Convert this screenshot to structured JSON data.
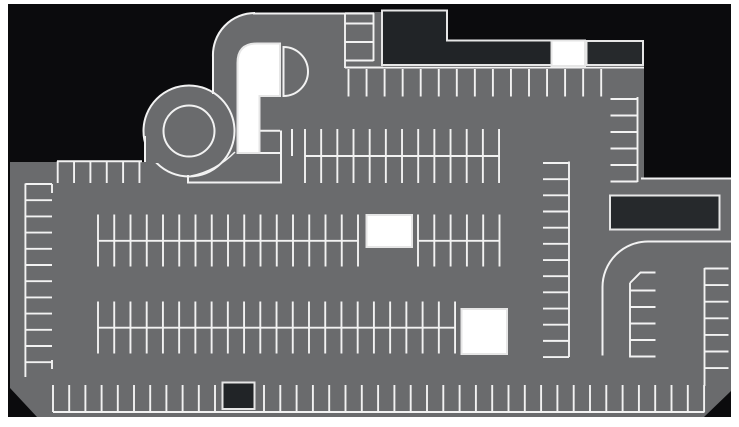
{
  "meta": {
    "title": "parking-lot-site-map",
    "width": 739,
    "height": 427
  },
  "colors": {
    "page": "#ffffff",
    "ground": "#0b0b0d",
    "lot": "#6a6b6d",
    "line": "#f2f2f2",
    "line_soft": "#e2e2e2",
    "building_dark": "#212427",
    "building_dark2": "#26292c",
    "building_white": "#ffffff",
    "outline": "#e6e6e6"
  },
  "map": {
    "ground": {
      "name": "ground-plane",
      "x": 8,
      "y": 4,
      "w": 723,
      "h": 413
    },
    "grays": [
      {
        "type": "rect",
        "name": "main-lot-surface",
        "x": 10,
        "y": 162,
        "w": 721,
        "h": 255
      },
      {
        "type": "rect",
        "name": "upper-lot-surface",
        "x": 345,
        "y": 67,
        "w": 299,
        "h": 123
      },
      {
        "type": "path",
        "name": "ramp-corner-surface",
        "d": "M213,93 L213,57 A42 42 0 0 1 255,13 L345,13 L345,190 L213,190 Z"
      },
      {
        "type": "rect",
        "name": "upper-stall-strip",
        "x": 345,
        "y": 12,
        "w": 38,
        "h": 56
      },
      {
        "type": "circle",
        "name": "spiral-ramp-disk",
        "cx": 189,
        "cy": 131,
        "r": 45.5,
        "stroke": true
      },
      {
        "type": "path",
        "name": "lot-edge-wedge",
        "d": "M145,163 L145,135 Q151,154 160,163 Z"
      }
    ],
    "patches": [
      {
        "type": "rect",
        "name": "ground-notch-topright",
        "x": 644,
        "y": 162,
        "w": 87,
        "h": 17
      },
      {
        "type": "path",
        "name": "cut-corner-bottomleft",
        "d": "M10,388 L37,417 L10,417 Z"
      },
      {
        "type": "path",
        "name": "cut-corner-bottomright",
        "d": "M731,391 L731,417 L704,417 Z"
      }
    ],
    "roads": [
      {
        "type": "circle",
        "name": "spiral-ramp-inner-circle",
        "cx": 189,
        "cy": 131,
        "r": 25.5
      },
      {
        "type": "path",
        "name": "ramp-corner-curb",
        "d": "M213,57 A42 42 0 0 1 255,13"
      },
      {
        "type": "line",
        "name": "ramp-west-curb",
        "x1": 213,
        "y1": 57,
        "x2": 213,
        "y2": 94
      },
      {
        "type": "line",
        "name": "north-curb-line",
        "x1": 253,
        "y1": 13.5,
        "x2": 374,
        "y2": 13.5
      },
      {
        "type": "line",
        "name": "west-curb-line",
        "x1": 145,
        "y1": 136,
        "x2": 145,
        "y2": 162
      },
      {
        "type": "line",
        "name": "northwest-curb-line",
        "x1": 57,
        "y1": 161.3,
        "x2": 142,
        "y2": 161.3
      },
      {
        "type": "path",
        "name": "ramp-stem-curb",
        "d": "M188,175 L188,182.5 L281,182.5 L281,130.5"
      },
      {
        "type": "path",
        "name": "ramp-stem-arc",
        "d": "M191,176 Q216,171 235,152",
        "w": 1.5
      },
      {
        "type": "line",
        "name": "ramp-base-line",
        "x1": 238,
        "y1": 153,
        "x2": 280,
        "y2": 153
      },
      {
        "type": "line",
        "name": "ramp-bay-top",
        "x1": 260,
        "y1": 130.8,
        "x2": 280,
        "y2": 130.8
      },
      {
        "type": "line",
        "name": "stall-divider",
        "x1": 292,
        "y1": 129,
        "x2": 292,
        "y2": 156
      },
      {
        "type": "path",
        "name": "half-circle-island",
        "d": "M283.5,47 A24.5 24.5 0 0 1 283.5,96 Z"
      },
      {
        "type": "path",
        "name": "east-exit-curve",
        "d": "M731,241.5 L648,241.5 A45.5 45.5 0 0 0 602.5,287 L602.5,355.5"
      },
      {
        "type": "line",
        "name": "northeast-curb-line",
        "x1": 641,
        "y1": 178.5,
        "x2": 731,
        "y2": 178.5
      }
    ],
    "combs": [
      {
        "name": "stall-row-northwest",
        "teeth": [
          {
            "axis": "x",
            "start": 57.7,
            "step": 16.35,
            "count": 6,
            "a": 161,
            "b": 183
          }
        ],
        "lines": []
      },
      {
        "name": "stall-column-west",
        "teeth": [
          {
            "axis": "y",
            "start": 184,
            "step": 16.2,
            "count": 12,
            "a": 25.4,
            "b": 52
          }
        ],
        "lines": [
          [
            25.4,
            183.5,
            25.4,
            377
          ],
          [
            52,
            184,
            52,
            193
          ],
          [
            52,
            360,
            52,
            369
          ]
        ]
      },
      {
        "name": "stall-row-upper-middle",
        "teeth": [
          {
            "axis": "x",
            "start": 305,
            "step": 16.17,
            "count": 13,
            "a": 129,
            "b": 183
          }
        ],
        "lines": [
          [
            305,
            156,
            499,
            156
          ]
        ]
      },
      {
        "name": "stall-row-center-1",
        "teeth": [
          {
            "axis": "x",
            "start": 98,
            "step": 16.25,
            "count": 17,
            "a": 214.5,
            "b": 266.5
          },
          {
            "axis": "x",
            "start": 418,
            "step": 16.3,
            "count": 6,
            "a": 214.5,
            "b": 266.5
          }
        ],
        "lines": [
          [
            98,
            240.8,
            358,
            240.8
          ],
          [
            418,
            240.8,
            500,
            240.8
          ]
        ]
      },
      {
        "name": "stall-row-center-2",
        "teeth": [
          {
            "axis": "x",
            "start": 98,
            "step": 16.23,
            "count": 23,
            "a": 301.5,
            "b": 353.5
          }
        ],
        "lines": [
          [
            98,
            327.7,
            455,
            327.7
          ]
        ]
      },
      {
        "name": "stall-row-north",
        "teeth": [
          {
            "axis": "x",
            "start": 348.5,
            "step": 18.05,
            "count": 15,
            "a": 69,
            "b": 96.5
          }
        ],
        "lines": [
          [
            345,
            67.5,
            644,
            67.5
          ]
        ]
      },
      {
        "name": "stall-strip-north",
        "teeth": [
          {
            "axis": "y",
            "start": 23.5,
            "step": 18.5,
            "count": 3,
            "a": 345,
            "b": 373.5
          }
        ],
        "lines": [
          [
            345,
            13,
            345,
            68
          ],
          [
            373.5,
            13,
            373.5,
            61
          ]
        ]
      },
      {
        "name": "stall-column-mid-east",
        "teeth": [
          {
            "axis": "y",
            "start": 163,
            "step": 16.17,
            "count": 13,
            "a": 543,
            "b": 569
          }
        ],
        "lines": [
          [
            569,
            161.5,
            569,
            357
          ]
        ]
      },
      {
        "name": "stall-column-upper-east",
        "teeth": [
          {
            "axis": "y",
            "start": 99,
            "step": 16.5,
            "count": 6,
            "a": 610.5,
            "b": 637.5
          }
        ],
        "lines": [
          [
            637.5,
            97,
            637.5,
            182
          ]
        ]
      },
      {
        "name": "stall-column-far-east",
        "teeth": [
          {
            "axis": "y",
            "start": 268.5,
            "step": 16.6,
            "count": 7,
            "a": 704.5,
            "b": 728.5
          }
        ],
        "lines": [
          [
            704.5,
            268,
            704.5,
            386
          ]
        ]
      },
      {
        "name": "stall-row-south",
        "teeth": [
          {
            "axis": "x",
            "start": 53,
            "step": 16.2,
            "count": 11,
            "a": 385,
            "b": 412
          },
          {
            "axis": "x",
            "start": 264,
            "step": 16.3,
            "count": 28,
            "a": 385,
            "b": 412
          }
        ],
        "lines": [
          [
            53,
            412,
            704.5,
            412
          ]
        ]
      },
      {
        "name": "stall-bay-exit-curve",
        "teeth": [
          {
            "axis": "y",
            "start": 290.5,
            "step": 16.5,
            "count": 5,
            "a": 630,
            "b": 655.5
          }
        ],
        "lines": [
          [
            630,
            283,
            630,
            357.5
          ]
        ],
        "paths": [
          "M630,283 L640.5,272.5 L655.5,272.5"
        ]
      }
    ],
    "buildings": [
      {
        "type": "path",
        "name": "building-north-L",
        "fill": "dark",
        "d": "M382,10.5 L447,10.5 L447,40.5 L551.5,40.5 L551.5,65 L382,65 Z"
      },
      {
        "type": "rect",
        "name": "building-north-white",
        "fill": "white",
        "x": 551.5,
        "y": 40.5,
        "w": 33.5,
        "h": 25.5
      },
      {
        "type": "rect",
        "name": "building-north-east",
        "fill": "dark2",
        "x": 586.5,
        "y": 41,
        "w": 56.5,
        "h": 24
      },
      {
        "type": "rect",
        "name": "building-east",
        "fill": "dark2",
        "x": 610,
        "y": 195.5,
        "w": 109.5,
        "h": 34
      },
      {
        "type": "path",
        "name": "building-ramp-tower",
        "fill": "white",
        "d": "M237.5,153 L237.5,63 Q237.5,43.5 257,43.5 L280,43.5 L280,96 L259.5,96 L259.5,153 Z"
      },
      {
        "type": "rect",
        "name": "building-center-white",
        "fill": "white",
        "x": 366.5,
        "y": 215,
        "w": 45.5,
        "h": 32
      },
      {
        "type": "rect",
        "name": "building-south-white",
        "fill": "white",
        "x": 461.5,
        "y": 309,
        "w": 45.5,
        "h": 45
      },
      {
        "type": "rect",
        "name": "building-south-kiosk",
        "fill": "dark",
        "x": 222.5,
        "y": 382.5,
        "w": 32,
        "h": 26.5
      }
    ]
  }
}
